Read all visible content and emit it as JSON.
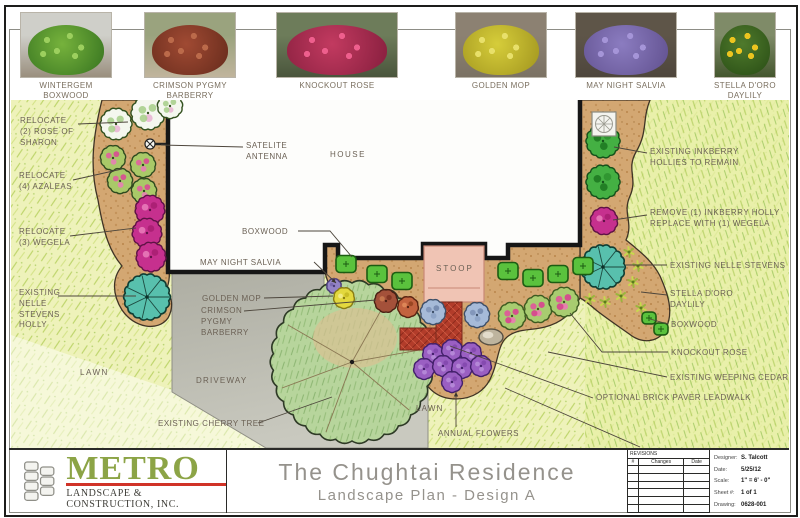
{
  "sheet": {
    "legend": {
      "items": [
        {
          "label": "WINTERGEM BOXWOOD",
          "colors": {
            "sky": "#cfcfc9",
            "ground": "#9a8f7e",
            "foliage": "#76b23c",
            "foliage_dark": "#3f7c24",
            "bloom": "#9ccf5e"
          }
        },
        {
          "label": "CRIMSON PYGMY\nBARBERRY",
          "colors": {
            "sky": "#9aa37e",
            "ground": "#c0b49c",
            "foliage": "#a04a33",
            "foliage_dark": "#6e2f1f",
            "bloom": "#bb6a4a"
          }
        },
        {
          "label": "KNOCKOUT ROSE",
          "colors": {
            "sky": "#6d7c5a",
            "ground": "#4a553c",
            "foliage": "#c23a60",
            "foliage_dark": "#8e2242",
            "bloom": "#ee5f8d"
          }
        },
        {
          "label": "GOLDEN MOP",
          "colors": {
            "sky": "#8c8172",
            "ground": "#7b7264",
            "foliage": "#d6cd3a",
            "foliage_dark": "#a89c22",
            "bloom": "#e8e06a"
          }
        },
        {
          "label": "MAY NIGHT SALVIA",
          "colors": {
            "sky": "#5e5548",
            "ground": "#4e463c",
            "foliage": "#8b7cc0",
            "foliage_dark": "#665695",
            "bloom": "#a595d8"
          }
        },
        {
          "label": "STELLA D'ORO\nDAYLILY",
          "colors": {
            "sky": "#7f8b68",
            "ground": "#44562e",
            "foliage": "#4f7a2c",
            "foliage_dark": "#2e5318",
            "bloom": "#ecc41f"
          }
        }
      ]
    },
    "plan": {
      "callouts": [
        {
          "id": "relocate-rose-of-sharon",
          "text": "RELOCATE\n(2) ROSE OF\nSHARON",
          "x": 20,
          "y": 116,
          "leader": [
            [
              78,
              124
            ],
            [
              128,
              122
            ]
          ]
        },
        {
          "id": "relocate-azaleas",
          "text": "RELOCATE\n(4) AZALEAS",
          "x": 19,
          "y": 171,
          "leader": [
            [
              73,
              180
            ],
            [
              122,
              169
            ]
          ]
        },
        {
          "id": "relocate-wegela",
          "text": "RELOCATE\n(3) WEGELA",
          "x": 19,
          "y": 227,
          "leader": [
            [
              70,
              236
            ],
            [
              136,
              228
            ]
          ]
        },
        {
          "id": "existing-nelle-stevens-holly",
          "text": "EXISTING\nNELLE\nSTEVENS\nHOLLY",
          "x": 19,
          "y": 288,
          "leader": [
            [
              58,
              296
            ],
            [
              136,
              296
            ]
          ]
        },
        {
          "id": "lawn-left",
          "text": "LAWN",
          "x": 80,
          "y": 368,
          "ls": 1.5
        },
        {
          "id": "existing-cherry-tree",
          "text": "EXISTING CHERRY TREE",
          "x": 158,
          "y": 419,
          "leader": [
            [
              258,
              423
            ],
            [
              332,
              397
            ]
          ]
        },
        {
          "id": "satelite-antenna",
          "text": "SATELITE\nANTENNA",
          "x": 246,
          "y": 141,
          "leader": [
            [
              243,
              147
            ],
            [
              161,
              145
            ]
          ]
        },
        {
          "id": "house",
          "text": "HOUSE",
          "x": 330,
          "y": 150,
          "ls": 1.5
        },
        {
          "id": "boxwood-left",
          "text": "BOXWOOD",
          "x": 242,
          "y": 227,
          "leader": [
            [
              298,
              231
            ],
            [
              330,
              231
            ],
            [
              352,
              257
            ]
          ]
        },
        {
          "id": "may-night-salvia",
          "text": "MAY NIGHT SALVIA",
          "x": 200,
          "y": 258,
          "leader": [
            [
              314,
              262
            ],
            [
              336,
              283
            ]
          ],
          "arrow": true
        },
        {
          "id": "golden-mop",
          "text": "GOLDEN MOP",
          "x": 202,
          "y": 294,
          "leader": [
            [
              264,
              298
            ],
            [
              333,
              296
            ]
          ]
        },
        {
          "id": "crimson-pygmy-barberry",
          "text": "CRIMSON\nPYGMY\nBARBERRY",
          "x": 201,
          "y": 306,
          "leader": [
            [
              244,
              311
            ],
            [
              376,
              300
            ]
          ]
        },
        {
          "id": "driveway",
          "text": "DRIVEWAY",
          "x": 196,
          "y": 376,
          "ls": 1.2
        },
        {
          "id": "lawn-bottom",
          "text": "LAWN",
          "x": 416,
          "y": 404,
          "ls": 1.2
        },
        {
          "id": "annual-flowers",
          "text": "ANNUAL FLOWERS",
          "x": 438,
          "y": 429,
          "leader": [
            [
              456,
              427
            ],
            [
              456,
              392
            ]
          ],
          "arrow": true
        },
        {
          "id": "existing-inkberry",
          "text": "EXISTING INKBERRY\nHOLLIES TO REMAIN",
          "x": 650,
          "y": 147,
          "leader": [
            [
              647,
              153
            ],
            [
              614,
              147
            ]
          ]
        },
        {
          "id": "remove-inkberry",
          "text": "REMOVE (1) INKBERRY HOLLY\nREPLACE WITH (1) WEGELA",
          "x": 650,
          "y": 208,
          "leader": [
            [
              647,
              215
            ],
            [
              613,
              220
            ]
          ]
        },
        {
          "id": "existing-nelle-stevens-right",
          "text": "EXISTING NELLE STEVENS",
          "x": 670,
          "y": 261,
          "leader": [
            [
              667,
              265
            ],
            [
              626,
              265
            ]
          ]
        },
        {
          "id": "stella-doro-daylily",
          "text": "STELLA D'ORO\nDAYLILY",
          "x": 670,
          "y": 289,
          "leader": [
            [
              667,
              295
            ],
            [
              641,
              292
            ]
          ]
        },
        {
          "id": "boxwood-right",
          "text": "BOXWOOD",
          "x": 671,
          "y": 320,
          "leader": [
            [
              668,
              324
            ],
            [
              650,
              319
            ]
          ]
        },
        {
          "id": "knockout-rose",
          "text": "KNOCKOUT ROSE",
          "x": 671,
          "y": 348,
          "leader": [
            [
              668,
              352
            ],
            [
              602,
              352
            ],
            [
              570,
              313
            ]
          ]
        },
        {
          "id": "existing-weeping-cedar",
          "text": "EXISTING WEEPING CEDAR",
          "x": 670,
          "y": 373,
          "leader": [
            [
              667,
              377
            ],
            [
              548,
              352
            ]
          ]
        },
        {
          "id": "optional-brick-paver-leadwalk",
          "text": "OPTIONAL BRICK PAVER LEADWALK",
          "x": 596,
          "y": 393,
          "leader": [
            [
              593,
              398
            ],
            [
              450,
              346
            ]
          ]
        },
        {
          "id": "stoop",
          "text": "STOOP",
          "x": 436,
          "y": 264,
          "ls": 2
        }
      ],
      "extra_lines": [
        [
          [
            505,
            388
          ],
          [
            640,
            447
          ]
        ]
      ],
      "plants": [
        {
          "type": "rose_of_sharon",
          "x": 116,
          "y": 124,
          "r": 15
        },
        {
          "type": "rose_of_sharon",
          "x": 148,
          "y": 113,
          "r": 16
        },
        {
          "type": "rose_of_sharon",
          "x": 170,
          "y": 106,
          "r": 12
        },
        {
          "type": "azalea",
          "x": 113,
          "y": 158,
          "r": 12
        },
        {
          "type": "azalea",
          "x": 143,
          "y": 165,
          "r": 12
        },
        {
          "type": "azalea",
          "x": 120,
          "y": 181,
          "r": 12
        },
        {
          "type": "azalea",
          "x": 144,
          "y": 191,
          "r": 12
        },
        {
          "type": "weigela",
          "x": 150,
          "y": 210,
          "r": 14
        },
        {
          "type": "weigela",
          "x": 147,
          "y": 233,
          "r": 14
        },
        {
          "type": "weigela",
          "x": 151,
          "y": 257,
          "r": 14
        },
        {
          "type": "holly_nelle_stevens",
          "x": 147,
          "y": 297,
          "r": 22
        },
        {
          "type": "inkberry_holly",
          "x": 603,
          "y": 141,
          "r": 16
        },
        {
          "type": "inkberry_holly",
          "x": 603,
          "y": 182,
          "r": 16
        },
        {
          "type": "weigela",
          "x": 604,
          "y": 221,
          "r": 13
        },
        {
          "type": "holly_nelle_stevens",
          "x": 603,
          "y": 267,
          "r": 21
        },
        {
          "type": "daylily",
          "x": 629,
          "y": 252,
          "r": 5
        },
        {
          "type": "daylily",
          "x": 638,
          "y": 266,
          "r": 5
        },
        {
          "type": "daylily",
          "x": 633,
          "y": 282,
          "r": 5
        },
        {
          "type": "daylily",
          "x": 621,
          "y": 296,
          "r": 5
        },
        {
          "type": "daylily",
          "x": 605,
          "y": 302,
          "r": 5
        },
        {
          "type": "daylily",
          "x": 590,
          "y": 299,
          "r": 5
        },
        {
          "type": "daylily",
          "x": 641,
          "y": 308,
          "r": 5
        },
        {
          "type": "boxwood",
          "x": 346,
          "y": 264,
          "r": 10
        },
        {
          "type": "boxwood",
          "x": 377,
          "y": 274,
          "r": 10
        },
        {
          "type": "boxwood",
          "x": 402,
          "y": 281,
          "r": 10
        },
        {
          "type": "boxwood",
          "x": 508,
          "y": 271,
          "r": 10
        },
        {
          "type": "boxwood",
          "x": 533,
          "y": 278,
          "r": 10
        },
        {
          "type": "boxwood",
          "x": 558,
          "y": 274,
          "r": 10
        },
        {
          "type": "boxwood",
          "x": 583,
          "y": 266,
          "r": 10
        },
        {
          "type": "boxwood",
          "x": 649,
          "y": 318,
          "r": 7
        },
        {
          "type": "boxwood",
          "x": 661,
          "y": 329,
          "r": 7
        },
        {
          "type": "barberry",
          "x": 386,
          "y": 301,
          "r": 11
        },
        {
          "type": "barberry_orange",
          "x": 408,
          "y": 307,
          "r": 10
        },
        {
          "type": "salvia",
          "x": 433,
          "y": 312,
          "r": 12
        },
        {
          "type": "salvia",
          "x": 477,
          "y": 315,
          "r": 12
        },
        {
          "type": "salvia_small",
          "x": 334,
          "y": 286,
          "r": 7
        },
        {
          "type": "golden_mop",
          "x": 344,
          "y": 298,
          "r": 10
        },
        {
          "type": "knockout_rose",
          "x": 512,
          "y": 316,
          "r": 13
        },
        {
          "type": "knockout_rose",
          "x": 538,
          "y": 309,
          "r": 13
        },
        {
          "type": "knockout_rose",
          "x": 564,
          "y": 302,
          "r": 14
        },
        {
          "type": "annual",
          "x": 433,
          "y": 354,
          "r": 10
        },
        {
          "type": "annual",
          "x": 452,
          "y": 350,
          "r": 10
        },
        {
          "type": "annual",
          "x": 471,
          "y": 353,
          "r": 10
        },
        {
          "type": "annual",
          "x": 424,
          "y": 369,
          "r": 10
        },
        {
          "type": "annual",
          "x": 443,
          "y": 366,
          "r": 10
        },
        {
          "type": "annual",
          "x": 462,
          "y": 368,
          "r": 10
        },
        {
          "type": "annual",
          "x": 481,
          "y": 366,
          "r": 10
        },
        {
          "type": "annual",
          "x": 452,
          "y": 382,
          "r": 10
        },
        {
          "type": "boulder",
          "x": 491,
          "y": 337,
          "r": 12
        }
      ]
    },
    "title_block": {
      "logo": {
        "name": "METRO",
        "tagline": "LANDSCAPE & CONSTRUCTION, INC.",
        "brand_green": "#8ca446",
        "underline_red": "#d03328"
      },
      "title": "The Chughtai Residence",
      "subtitle": "Landscape Plan - Design A",
      "revisions": {
        "header": "REVISIONS",
        "columns": [
          "#",
          "Changes",
          "Date"
        ],
        "empty_rows": 6
      },
      "info": [
        {
          "label": "Designer",
          "value": "S. Talcott"
        },
        {
          "label": "Date",
          "value": "5/25/12"
        },
        {
          "label": "Scale",
          "value": "1\" = 6' - 0\""
        },
        {
          "label": "Sheet #",
          "value": "1 of 1"
        },
        {
          "label": "Drawing",
          "value": "0628-001"
        }
      ]
    }
  }
}
